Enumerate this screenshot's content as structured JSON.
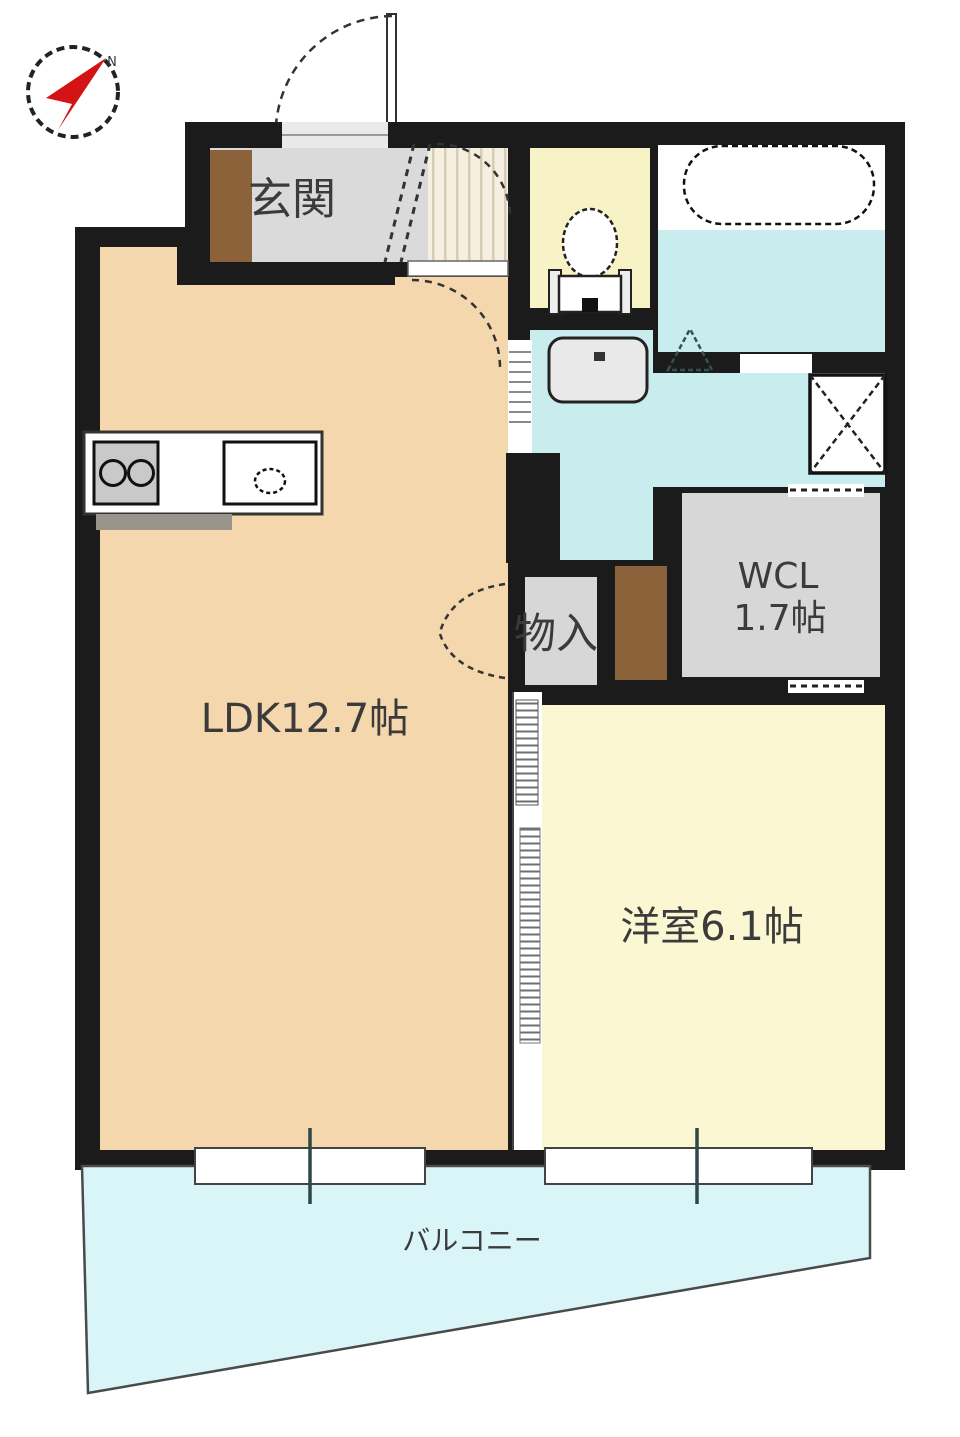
{
  "compass": {
    "north_label": "N"
  },
  "rooms": {
    "entrance": {
      "label": "玄関"
    },
    "ldk": {
      "label": "LDK12.7帖"
    },
    "storage": {
      "label": "物入"
    },
    "walk_in_closet": {
      "label_line1": "WCL",
      "label_line2": "1.7帖"
    },
    "western_room": {
      "label": "洋室6.1帖"
    },
    "balcony": {
      "label": "バルコニー"
    }
  },
  "colors": {
    "wall": "#1b1b1b",
    "ldk_floor": "#f4d7ad",
    "bedroom_floor": "#fbf7d3",
    "toilet_floor": "#f7f3c6",
    "wet_area_floor": "#c9ecef",
    "balcony_floor": "#d9f5f7",
    "genkan_floor": "#dadada",
    "closet_floor": "#d7d7d7",
    "hallway_floor": "#f5efdf",
    "wood_brown": "#8b6239",
    "compass_red": "#d41414",
    "label_text": "#3b3b3b"
  }
}
